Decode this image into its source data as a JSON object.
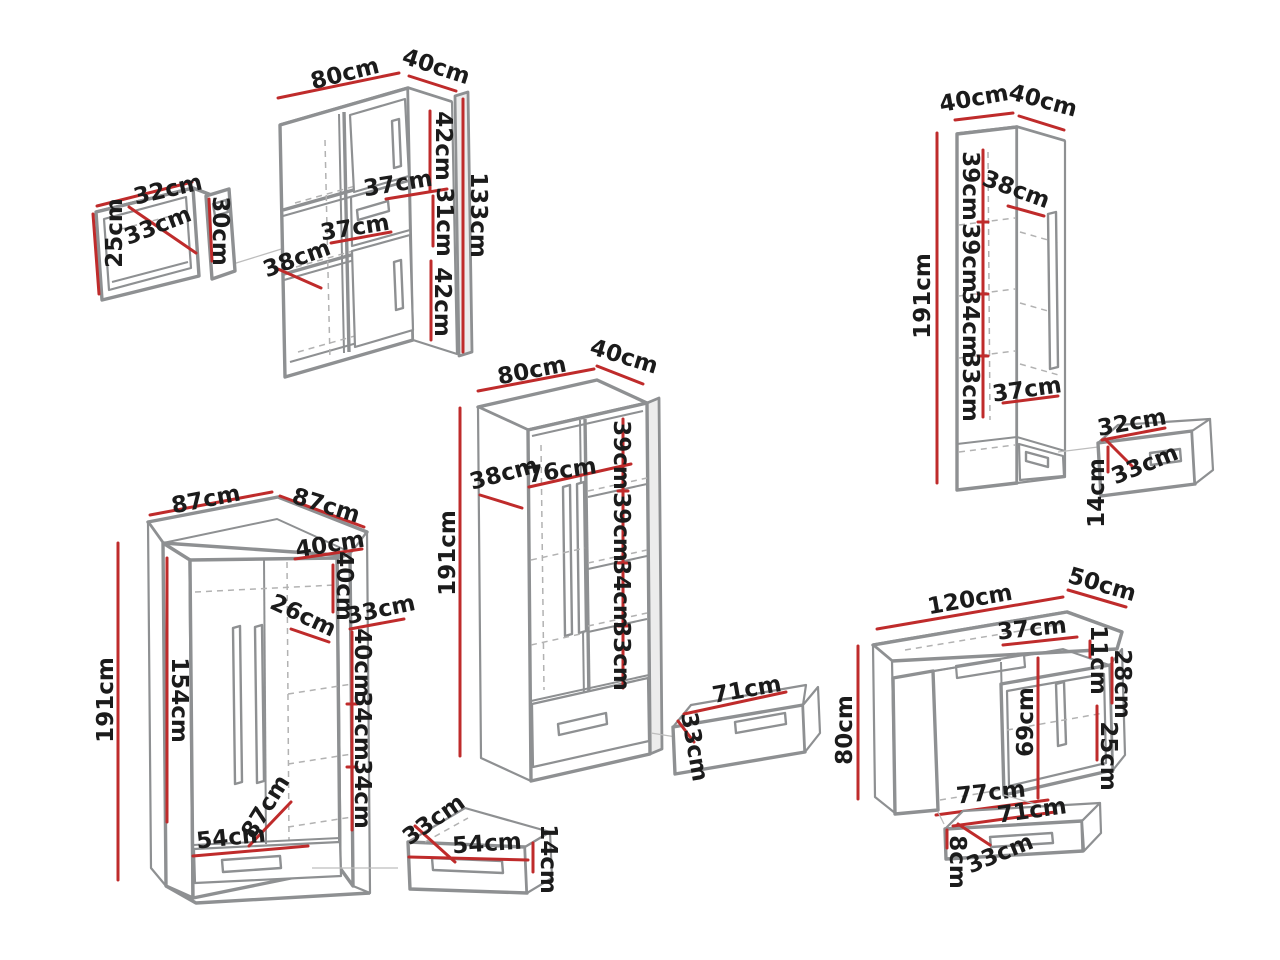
{
  "background": "#ffffff",
  "unit": "cm",
  "colors": {
    "dimension_line": "#bf2b2b",
    "furniture_line": "#8e9092",
    "hidden_line": "#b2b2b2",
    "label_text": "#1b1b1b"
  },
  "pieces": {
    "wall_shelf": {
      "label": "wall shelf box",
      "width": "32cm",
      "depth": "33cm",
      "height": "25cm",
      "front_height": "30cm"
    },
    "bookcase": {
      "label": "bookcase 80x40x133",
      "width": "80cm",
      "depth": "40cm",
      "height": "133cm",
      "door_top": "42cm",
      "shelf_width": "37cm",
      "middle_section": "31cm",
      "middle_width": "37cm",
      "inner_depth": "38cm",
      "door_bottom": "42cm"
    },
    "tall_cabinet": {
      "label": "tall cabinet 40x40x191",
      "width": "40cm",
      "depth": "40cm",
      "height": "191cm",
      "section_1": "39cm",
      "section_2": "39cm",
      "section_3": "34cm",
      "section_4": "33cm",
      "inner_depth": "38cm",
      "shelf_width": "37cm",
      "drawer": {
        "width": "32cm",
        "depth": "33cm",
        "height": "14cm"
      }
    },
    "wardrobe": {
      "label": "wardrobe 80x40x191",
      "width": "80cm",
      "depth": "40cm",
      "height": "191cm",
      "inner_depth": "38cm",
      "inner_width": "76cm",
      "section_1": "39cm",
      "section_2": "39cm",
      "section_3": "34cm",
      "section_4": "33cm",
      "drawer": {
        "width": "71cm",
        "depth": "33cm"
      }
    },
    "corner_wardrobe": {
      "label": "corner wardrobe 87x87x191",
      "width_left": "87cm",
      "width_right": "87cm",
      "height": "191cm",
      "door_height": "154cm",
      "top_width": "40cm",
      "top_height": "40cm",
      "top_depth": "26cm",
      "side_width": "33cm",
      "section_1": "40cm",
      "section_2": "34cm",
      "section_3": "34cm",
      "diagonal": "87cm",
      "bottom_width": "54cm",
      "drawer": {
        "depth": "33cm",
        "width": "54cm",
        "height": "14cm"
      }
    },
    "desk": {
      "label": "desk 120x50x80",
      "width": "120cm",
      "depth": "50cm",
      "height": "80cm",
      "niche_width": "37cm",
      "drawer_front": "11cm",
      "top_section": "28cm",
      "door_height": "69cm",
      "door_width": "25cm",
      "kneehole_width": "77cm",
      "tray": {
        "width": "71cm",
        "height": "8cm",
        "depth": "33cm"
      }
    }
  }
}
